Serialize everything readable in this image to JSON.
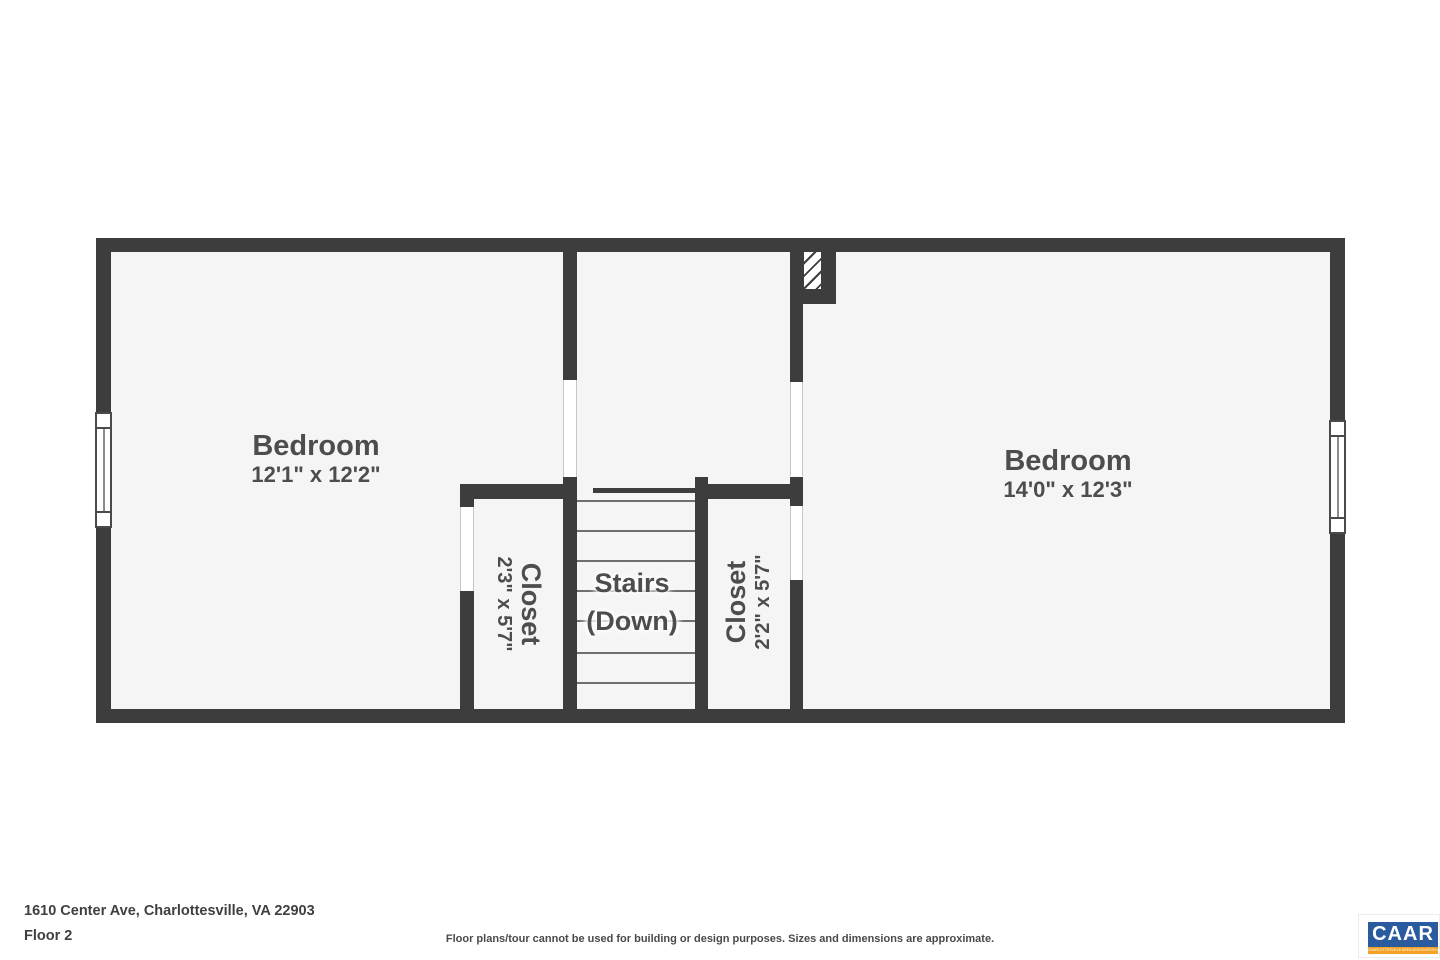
{
  "plan": {
    "rooms": {
      "bedroom_left": {
        "label": "Bedroom",
        "dimensions": "12'1\" x 12'2\""
      },
      "bedroom_right": {
        "label": "Bedroom",
        "dimensions": "14'0\" x 12'3\""
      },
      "closet_left": {
        "label": "Closet",
        "dimensions": "2'3\" x 5'7\""
      },
      "closet_right": {
        "label": "Closet",
        "dimensions": "2'2\" x 5'7\""
      },
      "stairs": {
        "label_line1": "Stairs",
        "label_line2": "(Down)"
      }
    }
  },
  "footer": {
    "address": "1610 Center Ave, Charlottesville, VA 22903",
    "floor": "Floor 2",
    "disclaimer": "Floor plans/tour cannot be used for building or design purposes. Sizes and dimensions are approximate."
  },
  "logo": {
    "text": "CAAR",
    "tagline": "CHARLOTTESVILLE AREA ASSOCIATION of REALTORS",
    "colors": {
      "blue": "#2a5b9f",
      "orange": "#f2a124"
    }
  },
  "colors": {
    "wall": "#3d3d3d",
    "floor": "#f5f5f5",
    "text": "#4d4d4d"
  }
}
